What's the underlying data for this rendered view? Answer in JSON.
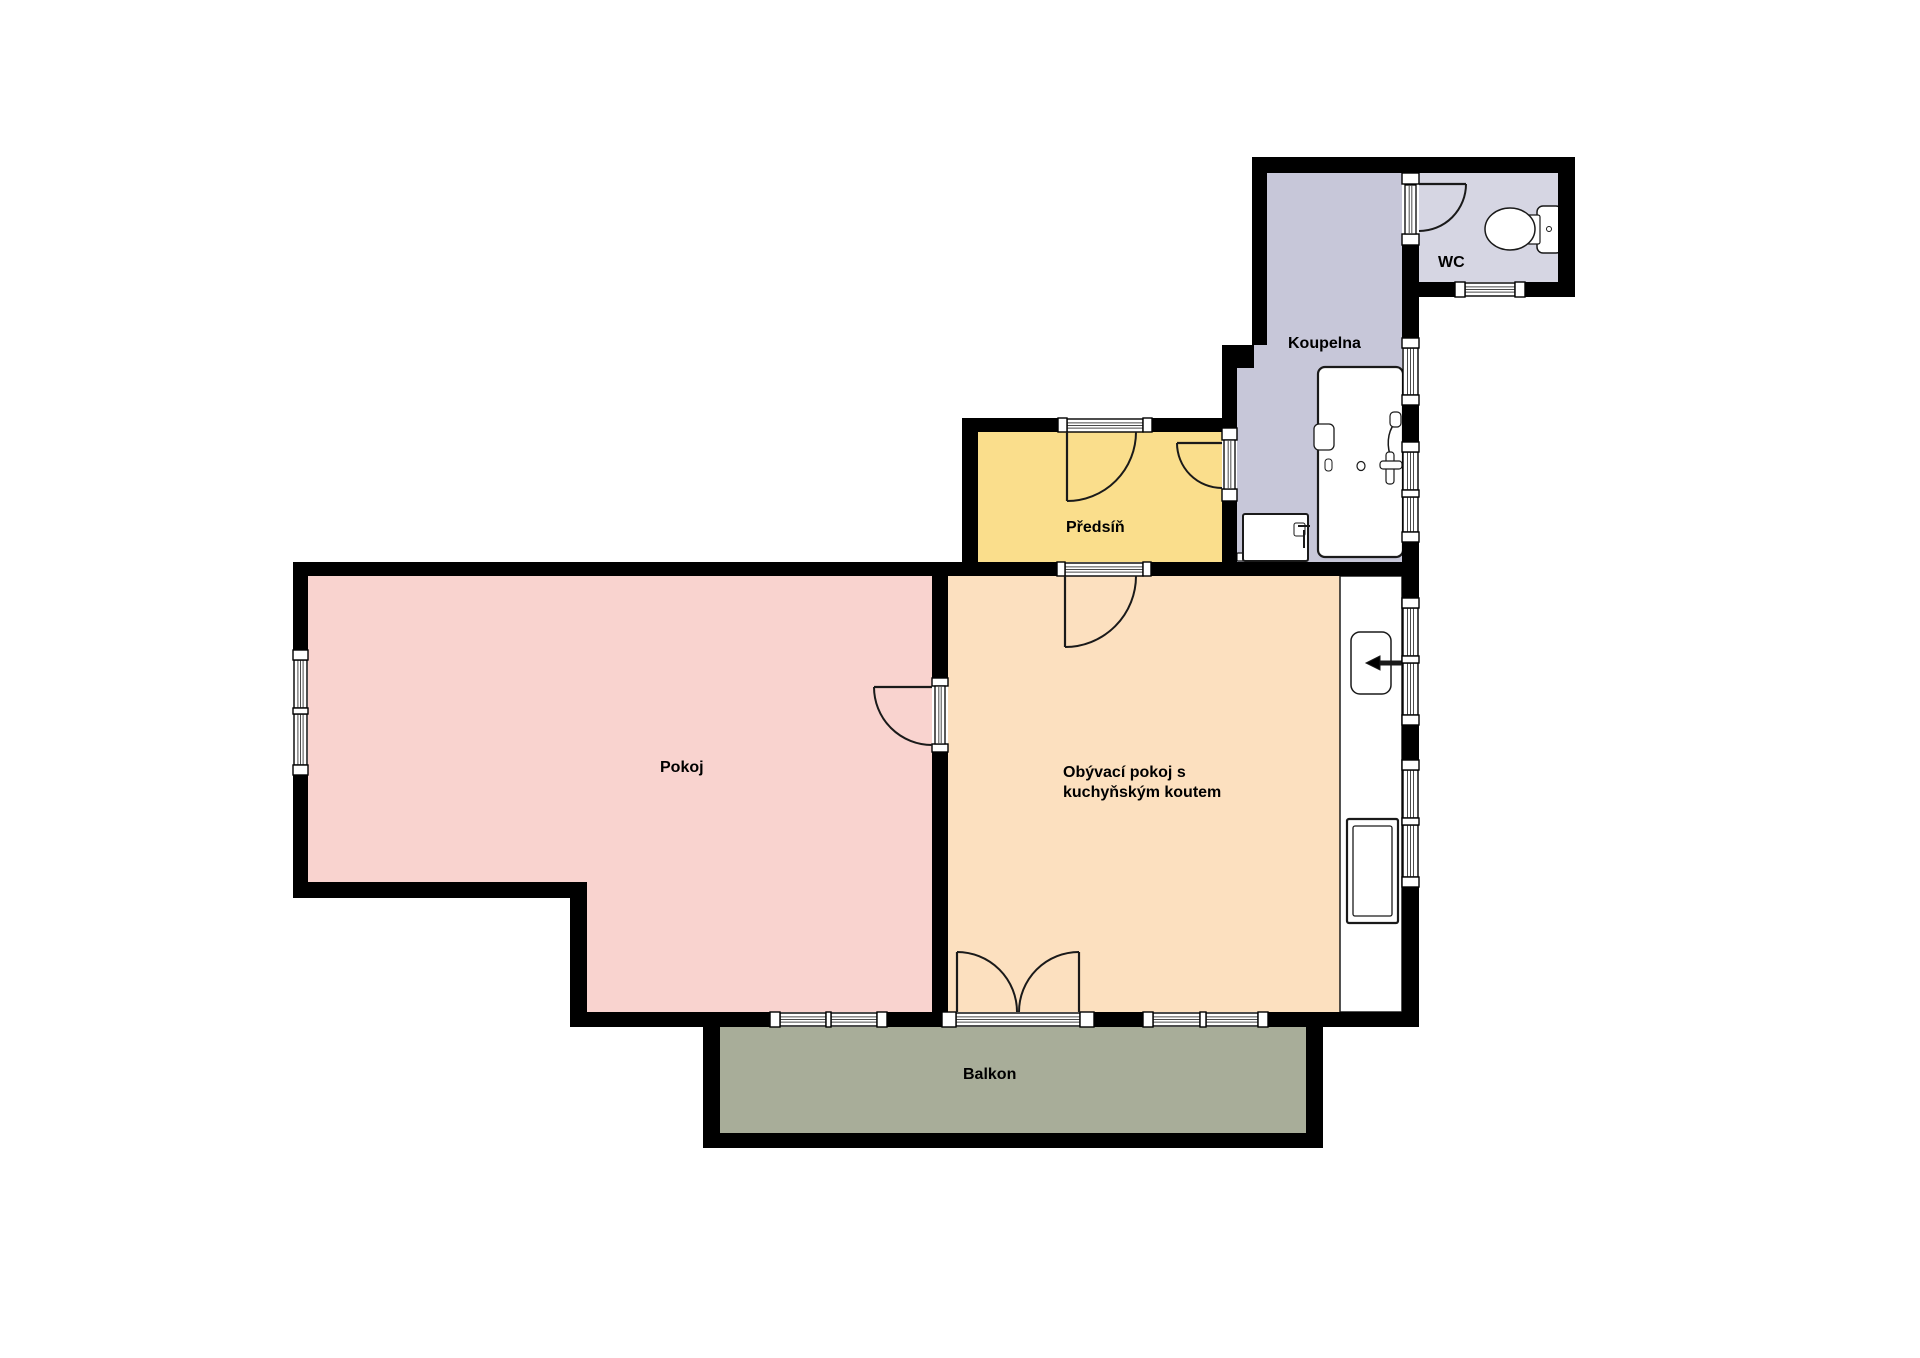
{
  "canvas": {
    "w": 1920,
    "h": 1358,
    "bg": "#ffffff"
  },
  "styles": {
    "wall_color": "#000000",
    "door_color": "#1a1a1a",
    "glass_line_color": "#4a4a4a",
    "glass_fill": "#ffffff",
    "fixture_stroke": "#1a1a1a",
    "label_color": "#000000",
    "label_size": 16,
    "label_line_height": 20
  },
  "rooms": [
    {
      "id": "pokoj",
      "fill": "#f9d3cf",
      "poly": [
        [
          308,
          576
        ],
        [
          932,
          576
        ],
        [
          932,
          1012
        ],
        [
          587,
          1012
        ],
        [
          587,
          882
        ],
        [
          308,
          882
        ]
      ],
      "label": {
        "x": 660,
        "y": 772,
        "anchor": "start",
        "lines": [
          "Pokoj"
        ]
      }
    },
    {
      "id": "obyvaci-pokoj",
      "fill": "#fce0bf",
      "poly": [
        [
          948,
          576
        ],
        [
          1402,
          576
        ],
        [
          1402,
          1012
        ],
        [
          948,
          1012
        ]
      ],
      "label": {
        "x": 1063,
        "y": 777,
        "anchor": "start",
        "lines": [
          "Obývací pokoj s",
          "kuchyňským koutem"
        ]
      }
    },
    {
      "id": "predsin",
      "fill": "#fade8c",
      "poly": [
        [
          978,
          432
        ],
        [
          1222,
          432
        ],
        [
          1222,
          562
        ],
        [
          978,
          562
        ]
      ],
      "label": {
        "x": 1066,
        "y": 532,
        "anchor": "start",
        "lines": [
          "Předsíň"
        ]
      }
    },
    {
      "id": "koupelna",
      "fill": "#c7c7d9",
      "poly": [
        [
          1267,
          173
        ],
        [
          1402,
          173
        ],
        [
          1402,
          562
        ],
        [
          1237,
          562
        ],
        [
          1237,
          368
        ],
        [
          1252,
          368
        ],
        [
          1252,
          345
        ],
        [
          1267,
          345
        ]
      ],
      "label": {
        "x": 1288,
        "y": 348,
        "anchor": "start",
        "lines": [
          "Koupelna"
        ]
      }
    },
    {
      "id": "wc",
      "fill": "#d6d6e3",
      "poly": [
        [
          1419,
          173
        ],
        [
          1558,
          173
        ],
        [
          1558,
          282
        ],
        [
          1419,
          282
        ]
      ],
      "label": {
        "x": 1438,
        "y": 267,
        "anchor": "start",
        "lines": [
          "WC"
        ]
      }
    },
    {
      "id": "balkon",
      "fill": "#a8ad99",
      "poly": [
        [
          720,
          1027
        ],
        [
          1306,
          1027
        ],
        [
          1306,
          1133
        ],
        [
          720,
          1133
        ]
      ],
      "label": {
        "x": 963,
        "y": 1079,
        "anchor": "start",
        "lines": [
          "Balkon"
        ]
      }
    }
  ],
  "walls": [
    [
      1252,
      157,
      323,
      16
    ],
    [
      1558,
      157,
      17,
      140
    ],
    [
      1402,
      282,
      53,
      15
    ],
    [
      1525,
      282,
      50,
      15
    ],
    [
      1402,
      245,
      17,
      93
    ],
    [
      1402,
      405,
      17,
      37
    ],
    [
      1402,
      542,
      17,
      56
    ],
    [
      1402,
      725,
      17,
      35
    ],
    [
      1402,
      887,
      17,
      140
    ],
    [
      1252,
      157,
      15,
      188
    ],
    [
      1222,
      345,
      32,
      23
    ],
    [
      1222,
      368,
      15,
      60
    ],
    [
      1222,
      501,
      15,
      61
    ],
    [
      962,
      418,
      96,
      14
    ],
    [
      1152,
      418,
      85,
      14
    ],
    [
      962,
      418,
      16,
      158
    ],
    [
      293,
      562,
      764,
      14
    ],
    [
      1151,
      562,
      267,
      14
    ],
    [
      293,
      562,
      15,
      88
    ],
    [
      293,
      775,
      15,
      123
    ],
    [
      293,
      882,
      294,
      16
    ],
    [
      570,
      882,
      17,
      145
    ],
    [
      932,
      576,
      16,
      102
    ],
    [
      932,
      752,
      16,
      260
    ],
    [
      570,
      1012,
      200,
      15
    ],
    [
      887,
      1012,
      55,
      15
    ],
    [
      1094,
      1012,
      49,
      15
    ],
    [
      1268,
      1012,
      150,
      15
    ],
    [
      703,
      1027,
      17,
      121
    ],
    [
      703,
      1133,
      620,
      15
    ],
    [
      1306,
      1027,
      17,
      121
    ]
  ],
  "glass": [
    {
      "r": [
        1465,
        283,
        50,
        13
      ],
      "dir": "h",
      "name": "wc-window"
    },
    {
      "r": [
        1067,
        419,
        76,
        13
      ],
      "dir": "h",
      "name": "entrance-threshold"
    },
    {
      "r": [
        1065,
        563,
        78,
        13
      ],
      "dir": "h",
      "name": "hall-living-threshold"
    },
    {
      "r": [
        780,
        1013,
        46,
        13
      ],
      "dir": "h",
      "name": "pokoj-balcony-window-left"
    },
    {
      "r": [
        831,
        1013,
        46,
        13
      ],
      "dir": "h",
      "name": "pokoj-balcony-window-right"
    },
    {
      "r": [
        956,
        1013,
        124,
        13
      ],
      "dir": "h",
      "name": "balcony-door-threshold"
    },
    {
      "r": [
        1153,
        1013,
        47,
        13
      ],
      "dir": "h",
      "name": "living-balcony-window-left"
    },
    {
      "r": [
        1206,
        1013,
        52,
        13
      ],
      "dir": "h",
      "name": "living-balcony-window-right"
    },
    {
      "r": [
        1403,
        348,
        15,
        47
      ],
      "dir": "v",
      "name": "koupelna-window-1"
    },
    {
      "r": [
        1403,
        452,
        15,
        38
      ],
      "dir": "v",
      "name": "koupelna-window-2a"
    },
    {
      "r": [
        1403,
        497,
        15,
        35
      ],
      "dir": "v",
      "name": "koupelna-window-2b"
    },
    {
      "r": [
        1403,
        608,
        15,
        48
      ],
      "dir": "v",
      "name": "kitchen-window-1a"
    },
    {
      "r": [
        1403,
        663,
        15,
        52
      ],
      "dir": "v",
      "name": "kitchen-window-1b"
    },
    {
      "r": [
        1403,
        770,
        15,
        48
      ],
      "dir": "v",
      "name": "kitchen-window-2a"
    },
    {
      "r": [
        1403,
        825,
        15,
        52
      ],
      "dir": "v",
      "name": "kitchen-window-2b"
    },
    {
      "r": [
        294,
        660,
        13,
        48
      ],
      "dir": "v",
      "name": "pokoj-window-a"
    },
    {
      "r": [
        294,
        714,
        13,
        51
      ],
      "dir": "v",
      "name": "pokoj-window-b"
    }
  ],
  "blocks": [
    [
      1455,
      282,
      10,
      15
    ],
    [
      1515,
      282,
      10,
      15
    ],
    [
      1058,
      418,
      9,
      14
    ],
    [
      1143,
      418,
      9,
      14
    ],
    [
      1057,
      562,
      8,
      14
    ],
    [
      1143,
      562,
      8,
      14
    ],
    [
      770,
      1012,
      10,
      15
    ],
    [
      826,
      1012,
      5,
      15
    ],
    [
      877,
      1012,
      10,
      15
    ],
    [
      942,
      1012,
      14,
      15
    ],
    [
      1080,
      1012,
      14,
      15
    ],
    [
      1143,
      1012,
      10,
      15
    ],
    [
      1200,
      1012,
      6,
      15
    ],
    [
      1258,
      1012,
      10,
      15
    ],
    [
      1402,
      173,
      17,
      11
    ],
    [
      1402,
      234,
      17,
      11
    ],
    [
      1402,
      338,
      17,
      10
    ],
    [
      1402,
      395,
      17,
      10
    ],
    [
      1402,
      442,
      17,
      10
    ],
    [
      1402,
      490,
      17,
      7
    ],
    [
      1402,
      532,
      17,
      10
    ],
    [
      1402,
      598,
      17,
      10
    ],
    [
      1402,
      656,
      17,
      7
    ],
    [
      1402,
      715,
      17,
      10
    ],
    [
      1402,
      760,
      17,
      10
    ],
    [
      1402,
      818,
      17,
      7
    ],
    [
      1402,
      877,
      17,
      10
    ],
    [
      293,
      650,
      15,
      10
    ],
    [
      293,
      708,
      15,
      6
    ],
    [
      293,
      765,
      15,
      10
    ],
    [
      932,
      678,
      16,
      8
    ],
    [
      932,
      744,
      16,
      8
    ],
    [
      1222,
      428,
      15,
      12
    ],
    [
      1222,
      489,
      15,
      12
    ]
  ],
  "panels": [
    {
      "r": [
        1405,
        185,
        11,
        49
      ],
      "name": "wc-door-panel"
    },
    {
      "r": [
        1224,
        440,
        11,
        49
      ],
      "name": "koupelna-door-panel"
    },
    {
      "r": [
        935,
        686,
        10,
        58
      ],
      "name": "pokoj-door-panel"
    }
  ],
  "doors": [
    {
      "name": "wc-door",
      "leaf": [
        1419,
        184,
        1466,
        184
      ],
      "arc": "M1466,184 A47,47 0 0 1 1419,231"
    },
    {
      "name": "koupelna-door",
      "leaf": [
        1222,
        443,
        1177,
        443
      ],
      "arc": "M1177,443 A45,45 0 0 0 1222,488"
    },
    {
      "name": "entrance-door",
      "leaf": [
        1067,
        432,
        1067,
        501
      ],
      "arc": "M1067,501 A69,69 0 0 0 1136,432"
    },
    {
      "name": "hall-living-door",
      "leaf": [
        1065,
        576,
        1065,
        647
      ],
      "arc": "M1065,647 A71,71 0 0 0 1136,576"
    },
    {
      "name": "pokoj-door",
      "leaf": [
        932,
        687,
        874,
        687
      ],
      "arc": "M874,687 A58,58 0 0 0 932,745"
    },
    {
      "name": "balcony-door-left",
      "leaf": [
        957,
        1012,
        957,
        952
      ],
      "arc": "M957,952 A60,60 0 0 1 1017,1012"
    },
    {
      "name": "balcony-door-right",
      "leaf": [
        1079,
        1012,
        1079,
        952
      ],
      "arc": "M1079,952 A60,60 0 0 0 1019,1012"
    }
  ],
  "fixtures": [
    {
      "name": "kitchen-counter",
      "type": "rect",
      "x": 1340,
      "y": 576,
      "w": 62,
      "h": 436,
      "rx": 0,
      "sw": 1.5
    },
    {
      "name": "kitchen-sink",
      "type": "rect",
      "x": 1351,
      "y": 632,
      "w": 40,
      "h": 62,
      "rx": 9,
      "sw": 1.5
    },
    {
      "name": "kitchen-faucet-pipe",
      "type": "path",
      "d": "M1402,663 H1380",
      "sw": 5,
      "fill": "none"
    },
    {
      "name": "kitchen-faucet-head",
      "type": "path",
      "d": "M1380,656 L1366,663 L1380,670 Z",
      "sw": 1,
      "fill": "#000000"
    },
    {
      "name": "stove",
      "type": "rect",
      "x": 1347,
      "y": 819,
      "w": 51,
      "h": 104,
      "rx": 2,
      "sw": 2.2
    },
    {
      "name": "stove-inner",
      "type": "rect",
      "x": 1353,
      "y": 826,
      "w": 39,
      "h": 90,
      "rx": 2,
      "sw": 1.3
    },
    {
      "name": "bathtub",
      "type": "rect",
      "x": 1318,
      "y": 367,
      "w": 85,
      "h": 190,
      "rx": 7,
      "sw": 2.2
    },
    {
      "name": "bathtub-soap-dish",
      "type": "rect",
      "x": 1314,
      "y": 424,
      "w": 20,
      "h": 26,
      "rx": 5,
      "sw": 1.3
    },
    {
      "name": "bathtub-knob",
      "type": "rect",
      "x": 1325,
      "y": 459,
      "w": 7,
      "h": 12,
      "rx": 3,
      "sw": 1
    },
    {
      "name": "bathtub-drain",
      "type": "ellipse",
      "cx": 1361,
      "cy": 466,
      "rx": 4,
      "ry": 4.5,
      "sw": 1.2
    },
    {
      "name": "bathtub-shower-hose",
      "type": "path",
      "d": "M1397,421 C1389,428 1386,441 1390,455",
      "sw": 1.5,
      "fill": "none"
    },
    {
      "name": "bathtub-shower-head",
      "type": "rect",
      "x": 1390,
      "y": 412,
      "w": 11,
      "h": 15,
      "rx": 4,
      "sw": 1.2
    },
    {
      "name": "bathtub-mixer-vertical",
      "type": "rect",
      "x": 1386,
      "y": 452,
      "w": 8,
      "h": 32,
      "rx": 3,
      "sw": 1.2
    },
    {
      "name": "bathtub-mixer-horizontal",
      "type": "rect",
      "x": 1380,
      "y": 461,
      "w": 22,
      "h": 8,
      "rx": 3,
      "sw": 1.2
    },
    {
      "name": "washing-machine-base",
      "type": "rect",
      "x": 1237,
      "y": 553,
      "w": 71,
      "h": 8,
      "rx": 1,
      "sw": 1.2
    },
    {
      "name": "washing-machine",
      "type": "rect",
      "x": 1243,
      "y": 514,
      "w": 65,
      "h": 47,
      "rx": 2,
      "sw": 2
    },
    {
      "name": "washing-machine-handle",
      "type": "rect",
      "x": 1294,
      "y": 523,
      "w": 11,
      "h": 13,
      "rx": 2,
      "sw": 1
    },
    {
      "name": "washer-tap",
      "type": "path",
      "d": "M1304,548 V530 M1298,526 H1310",
      "sw": 2,
      "fill": "none"
    },
    {
      "name": "toilet-tank",
      "type": "rect",
      "x": 1537,
      "y": 206,
      "w": 25,
      "h": 47,
      "rx": 6,
      "sw": 1.5
    },
    {
      "name": "toilet-neck",
      "type": "rect",
      "x": 1527,
      "y": 215,
      "w": 13,
      "h": 29,
      "rx": 2,
      "sw": 1.2
    },
    {
      "name": "toilet-bowl",
      "type": "ellipse",
      "cx": 1510,
      "cy": 229,
      "rx": 25,
      "ry": 21,
      "sw": 1.5
    },
    {
      "name": "toilet-button",
      "type": "ellipse",
      "cx": 1549,
      "cy": 229,
      "rx": 2.5,
      "ry": 2.5,
      "sw": 1
    }
  ]
}
